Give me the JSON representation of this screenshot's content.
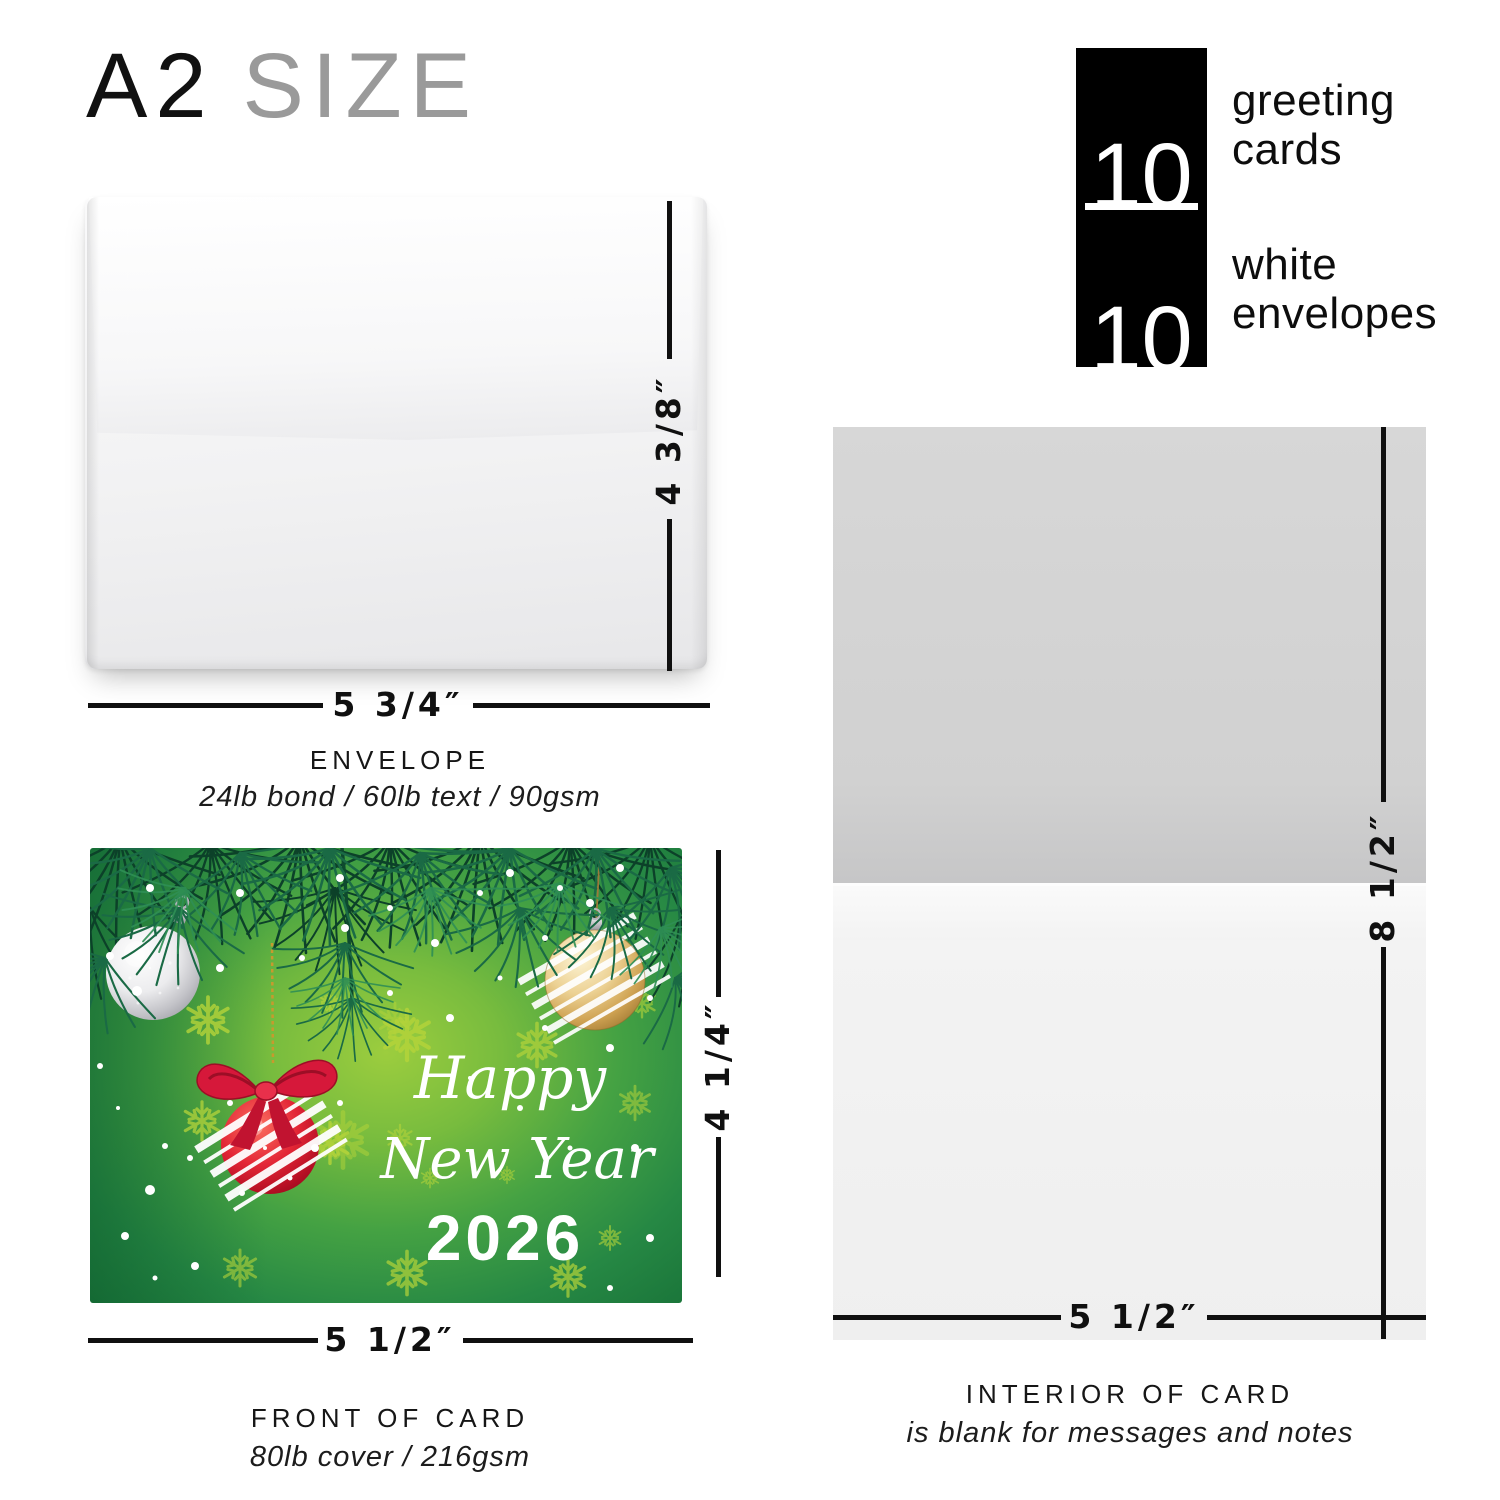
{
  "title": {
    "primary": "A2",
    "secondary": "SIZE"
  },
  "bundle": {
    "cards_count": "10",
    "cards_label_line1": "greeting",
    "cards_label_line2": "cards",
    "envelopes_count": "10",
    "envelopes_label_line1": "white",
    "envelopes_label_line2": "envelopes"
  },
  "envelope": {
    "height_label": "4 3/8″",
    "width_label": "5 3/4″",
    "name": "ENVELOPE",
    "spec": "24lb bond / 60lb text / 90gsm"
  },
  "front_card": {
    "height_label": "4 1/4″",
    "width_label": "5 1/2″",
    "name": "FRONT OF CARD",
    "spec": "80lb cover / 216gsm",
    "art": {
      "greeting_line1": "Happy",
      "greeting_line2": "New Year",
      "year": "2026"
    }
  },
  "interior_card": {
    "height_label": "8 1/2″",
    "width_label": "5 1/2″",
    "name": "INTERIOR OF CARD",
    "spec": "is blank for messages and notes"
  },
  "colors": {
    "card_green_light": "#9ccd3e",
    "card_green_dark": "#187238",
    "ornament_red": "#d6183a",
    "ornament_gold": "#cfa252",
    "ornament_silver": "#c2c2c7",
    "snowflake_accent": "#b5d43a",
    "count_box_bg": "#000000",
    "dim_line": "#101010"
  }
}
